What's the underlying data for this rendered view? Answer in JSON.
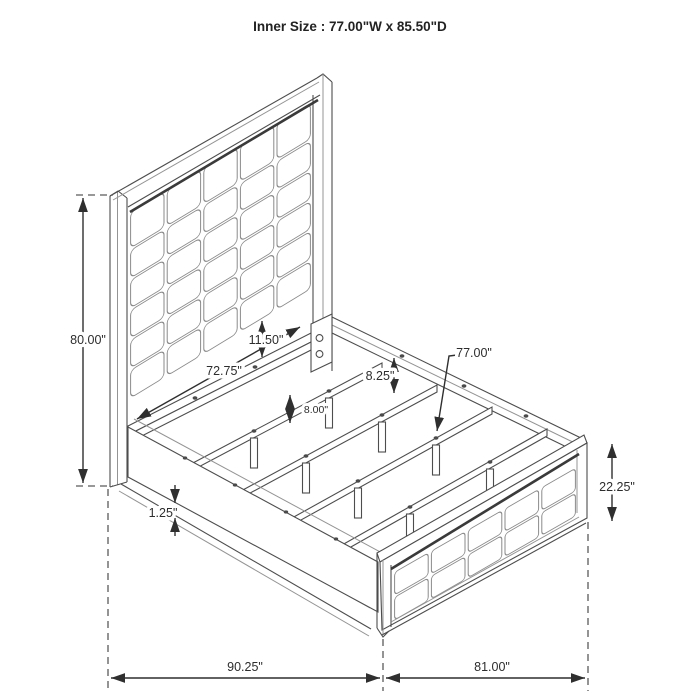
{
  "title": "Inner Size : 77.00\"W x 85.50\"D",
  "dimensions": {
    "headboard_height": "80.00\"",
    "headboard_width": "72.75\"",
    "panel_to_rail_gap": "11.50\"",
    "rail_top_to_slat": "8.25\"",
    "support_leg_height": "8.00\"",
    "slat_length": "77.00\"",
    "rail_ledge_thickness": "1.25\"",
    "footboard_height": "22.25\"",
    "overall_depth": "90.25\"",
    "overall_width": "81.00\""
  }
}
